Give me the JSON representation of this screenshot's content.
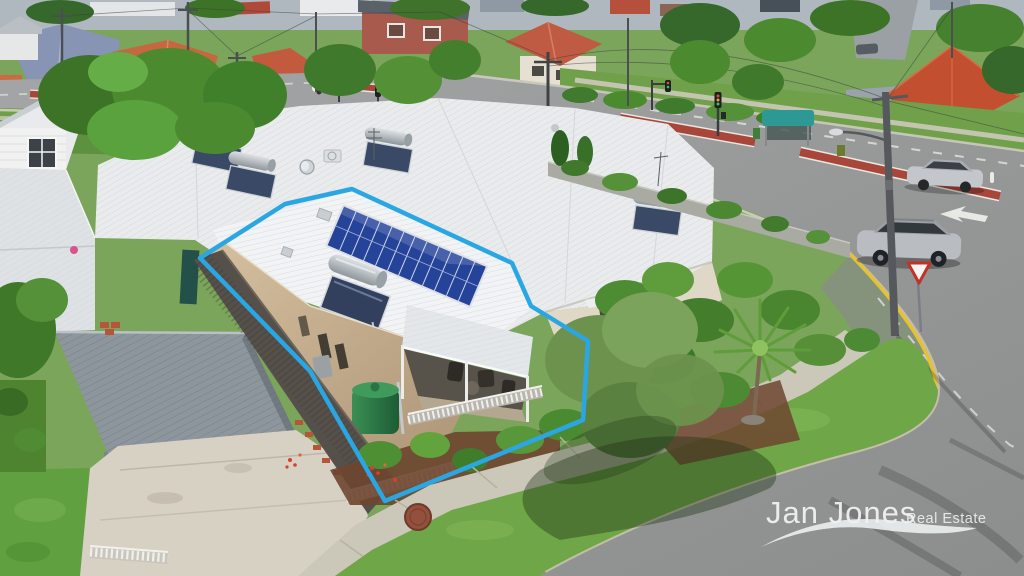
{
  "watermark": {
    "brand": "Jan Jones",
    "tagline": "Real Estate"
  },
  "scene": {
    "type": "aerial-drone-real-estate-photo",
    "setting": "sunny suburban corner block beside a signalised arterial road intersection",
    "highlight": {
      "label": "property-boundary",
      "outline_color": "#2aa7e3"
    },
    "subject_property": {
      "description": "single-storey corner unit with white corrugated curved roof",
      "features": [
        "12-panel rooftop solar array",
        "rooftop solar hot water system",
        "covered front veranda with outdoor furniture",
        "green rainwater tank",
        "timber paling side fence",
        "white picket garden fence",
        "garden beds with red flowering shrubs"
      ]
    },
    "surroundings": [
      "adjoining units with solar hot water systems",
      "grey metal carport with concrete driveway",
      "intersection with red painted medians and traffic lights",
      "give-way sign on yellow-lined corner kerb",
      "palm tree and large olive tree",
      "concrete footpath with round service cover",
      "teal bus shelter",
      "corner shop with purple awning",
      "silver SUV driving past, parked silver sedan",
      "white timber cottage and terracotta-roofed houses"
    ]
  },
  "palette": {
    "roof_white": "#edeff1",
    "roof_tan": "#c8b394",
    "solar_panel_blue": "#27479e",
    "water_tank_green": "#2e7d46",
    "lawn_green": "#6aa344",
    "road_grey": "#97999a",
    "median_red": "#a8463a",
    "kerb_yellow": "#e5c234",
    "carport_grey": "#8d969d"
  }
}
